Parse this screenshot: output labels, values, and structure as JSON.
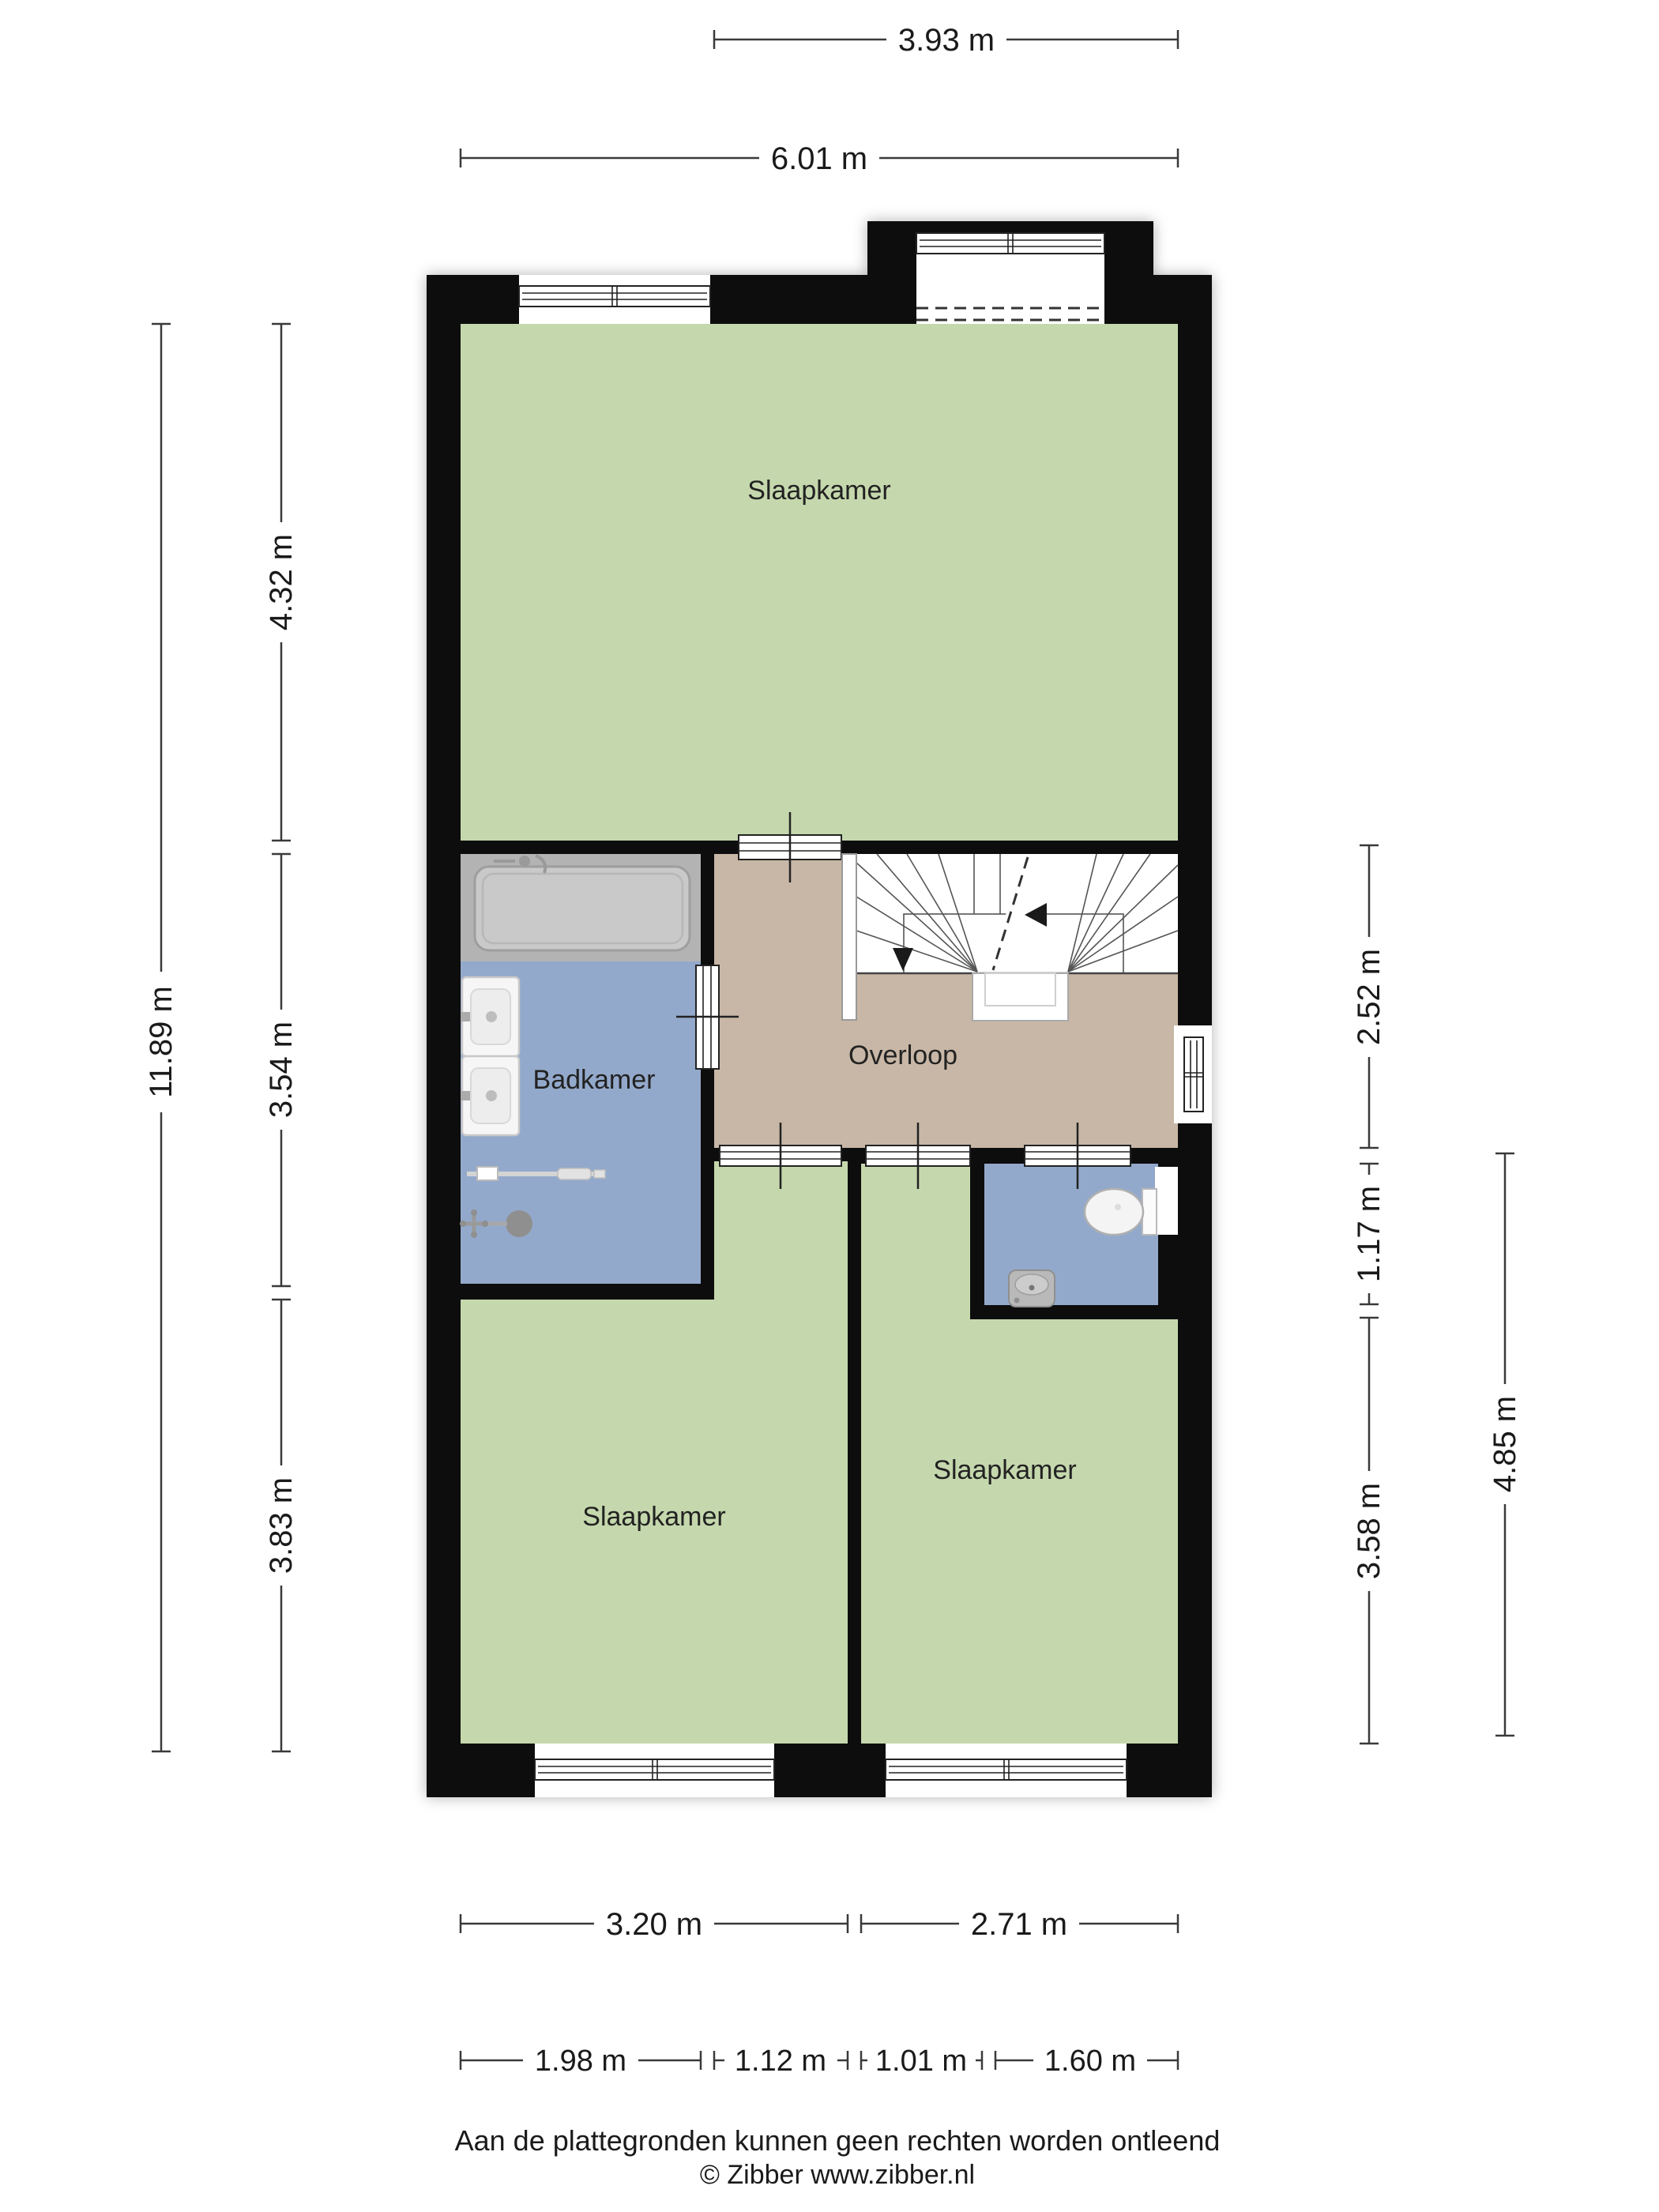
{
  "rooms": {
    "bedroom_top": {
      "label": "Slaapkamer"
    },
    "bathroom": {
      "label": "Badkamer"
    },
    "landing": {
      "label": "Overloop"
    },
    "bedroom_left": {
      "label": "Slaapkamer"
    },
    "bedroom_right": {
      "label": "Slaapkamer"
    }
  },
  "dimensions": {
    "top": {
      "landing_width": "3.93 m",
      "total_width": "6.01 m"
    },
    "left": {
      "total_height": "11.89 m",
      "seg_top": "4.32 m",
      "seg_mid": "3.54 m",
      "seg_bottom": "3.83 m"
    },
    "right": {
      "landing": "2.52 m",
      "toilet": "1.17 m",
      "bedroom": "3.58 m",
      "outer": "4.85 m"
    },
    "bottom_row1": {
      "left_room": "3.20 m",
      "right_room": "2.71 m"
    },
    "bottom_row2": {
      "bathroom": "1.98 m",
      "passage": "1.12 m",
      "doorway": "1.01 m",
      "toilet": "1.60 m"
    }
  },
  "footer": {
    "disclaimer": "Aan de plattegronden kunnen geen rechten worden ontleend",
    "copyright": "© Zibber www.zibber.nl"
  },
  "colors": {
    "wall": "#0c0c0c",
    "room_green": "#c5d8ad",
    "room_blue": "#93a9cb",
    "hall_tan": "#c8b7a6",
    "fixture_band": "#b3b3b3",
    "tub_fill": "#c9c9c9",
    "white": "#ffffff"
  }
}
